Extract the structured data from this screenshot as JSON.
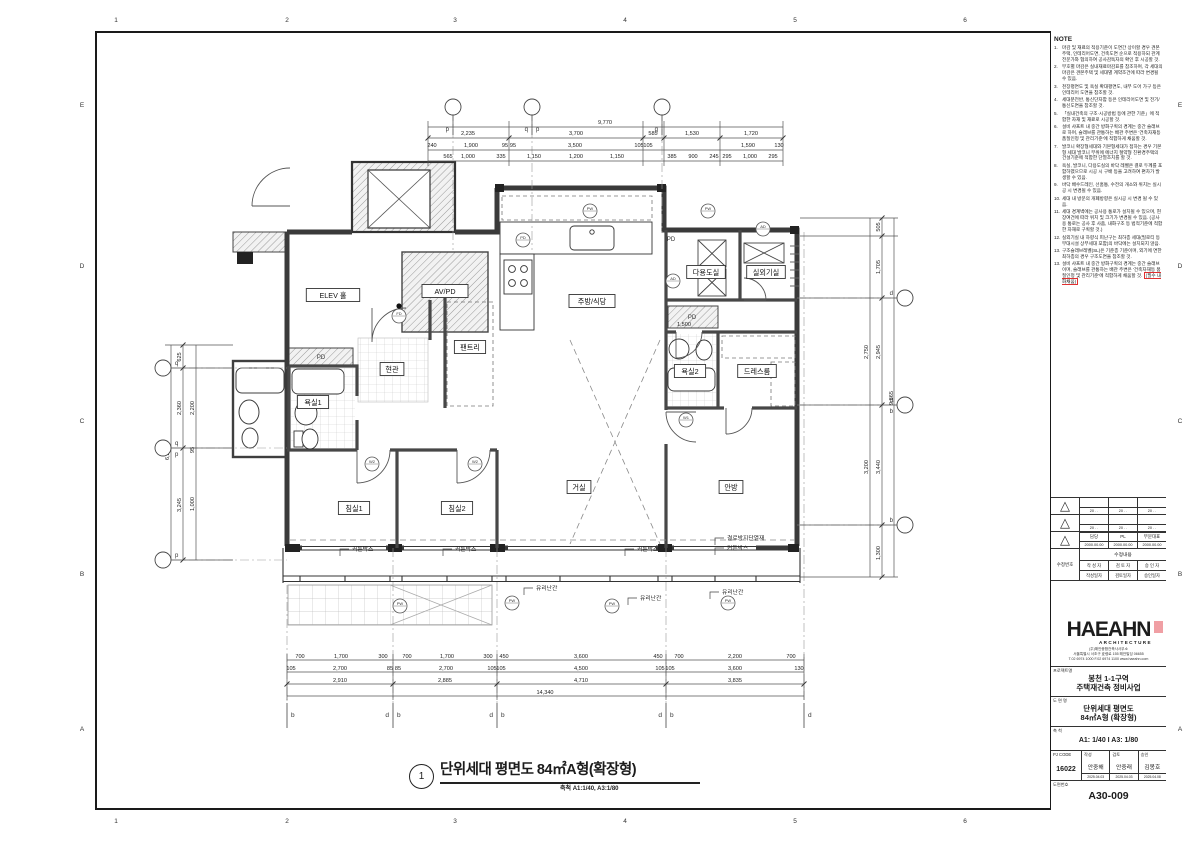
{
  "frame": {
    "cols": [
      "1",
      "2",
      "3",
      "4",
      "5",
      "6"
    ],
    "rows": [
      "E",
      "D",
      "C",
      "B",
      "A"
    ]
  },
  "notes": {
    "heading": "NOTE",
    "items": [
      {
        "no": "1.",
        "text": "마감 및 재료의 적용기준이 도면간 상이할 경우 견본주택, 인테리어도면, 건축도면 순으로 적용하되 관계전문가와 협의하여 공사감독자의 확인 후 시공할 것."
      },
      {
        "no": "2.",
        "text": "부호별 마감은 실내재료마감표를 참조하며, 각 세대의 마감은 견본주택 및 세대별 계약조건에 따라 변경될 수 있음."
      },
      {
        "no": "3.",
        "text": "천장평면도 및 욕실 확대평면도, 내부 도어 가구 등은 인테리어 도면을 참조할 것."
      },
      {
        "no": "4.",
        "text": "세대분전반, 통신단자함 등은 인테리어도면 및 전기/통신도면을 참조할 것."
      },
      {
        "no": "5.",
        "text": "「실내건축의 구조·시공방법 등에 관한 기준」에 적합한 자재 및 재료로 시공할 것."
      },
      {
        "no": "6.",
        "text": "설비 샤프트 내 중간 방화구획의 경계는 중간 슬래브로 하며, 슬래브를 관통하는 배관 주변은 '건축자재등 품질인정 및 관리기준'에 적합하게 채움할 것."
      },
      {
        "no": "7.",
        "text": "발코니 확장형세대와 기본형세대가 접하는 경우 기본형 세대 발코니 부위에 에너지 절약형 친환경주택의 건설기준에 적합한 단열조치를 할 것."
      },
      {
        "no": "8.",
        "text": "욕실, 발코니, 다용도실의 바닥 레벨은 결로 두께를 포함하였으므로 시공 시 구배 등을 고려하여 편차가 발생할 수 있음."
      },
      {
        "no": "9.",
        "text": "바닥 배수드레인, 선홈통, 수전의 개소와 위치는 실시공 시 변경될 수 있음."
      },
      {
        "no": "10.",
        "text": "세대 내 방문의 개폐방향은 실시공 시 변경 될 수 있음."
      },
      {
        "no": "11.",
        "text": "세대 경계벽에는 공사용 통로가 설치될 수 있으며, 현장여건에 따라 위치 및 크기가 변경될 수 있음. (공사용 통로는 공사 후 사춤, 내화구조 등 법적기준에 적합한 자재로 구획할 것.)"
      },
      {
        "no": "12.",
        "text": "실외기실 내 하향식 피난구는 최하층 세대(필로티 등 부대시설 상부세대 포함)의 바닥에는 설치되지 않음."
      },
      {
        "no": "13.",
        "text": "구조슬래브레벨(SL)은 기준층 기준이며, 외기에 면한 최하층의 경우 구조도면을 참조할 것."
      },
      {
        "no": "13.",
        "text": "설비 샤프트 내 중간 방화구획의 경계는 중간 슬래브이며, 슬래브를 관통하는 배관 주변은 '건축자재등 품질인정 및 관리기준'에 적합하게 채움할 것.",
        "hl": "(필수 내화채움)"
      }
    ]
  },
  "revision": {
    "rows": [
      {
        "cells": [
          "",
          "",
          ""
        ],
        "dates": [
          "20    .    .",
          "20    .    .",
          "20    .    ."
        ]
      },
      {
        "cells": [
          "",
          "",
          ""
        ],
        "dates": [
          "20    .    .",
          "20    .    .",
          "20    .    ."
        ]
      },
      {
        "cells": [
          "담당",
          "PL",
          "부문대표"
        ],
        "dates": [
          "2000.00.00",
          "2000.00.00",
          "2000.00.00"
        ]
      }
    ],
    "modify_label": "수정번호",
    "content_label": "수정내용",
    "writer_headers": [
      "작 성 자",
      "검 토 자",
      "승 인 자"
    ],
    "date_headers": [
      "작성일자",
      "검토일자",
      "승인일자"
    ]
  },
  "company": {
    "name": "HAEAHN",
    "sub": "ARCHITECTURE",
    "lines": [
      "(주)해안종합건축사사무소",
      "서울특별시 서초구 효령로 155 해안빌딩 06655",
      "T.02 6974 1000  F.02 6974 1100  www.haeahn.com"
    ]
  },
  "titleblock": {
    "project_label": "프로젝트명",
    "project_line1": "봉천 1-1구역",
    "project_line2": "주택재건축 정비사업",
    "drawing_label": "도 면 명",
    "drawing_line1": "단위세대 평면도",
    "drawing_line2": "84㎡A형 (확장형)",
    "scale_label": "축  척",
    "scale_value": "A1: 1/40  I  A3: 1/80",
    "pj_code_label": "PJ CODE",
    "pj_code": "16022",
    "staff": [
      {
        "role": "작성",
        "name": "안중해",
        "date": "2025.04.03"
      },
      {
        "role": "검토",
        "name": "안중래",
        "date": "2025.04.03"
      },
      {
        "role": "승인",
        "name": "김봉호",
        "date": "2025.04.08"
      }
    ],
    "drawing_no_label": "도면번호",
    "drawing_no": "A30-009"
  },
  "drawing_title": {
    "no": "1",
    "text": "단위세대 평면도 84㎡A형(확장형)",
    "scale": "축척 A1:1/40, A3:1/80"
  },
  "plan": {
    "rooms": [
      {
        "t": "ELEV 홀",
        "x": 333,
        "y": 295
      },
      {
        "t": "AV/PD",
        "x": 445,
        "y": 291
      },
      {
        "t": "현관",
        "x": 392,
        "y": 369
      },
      {
        "t": "욕실1",
        "x": 313,
        "y": 402
      },
      {
        "t": "팬트리",
        "x": 470,
        "y": 347
      },
      {
        "t": "주방/식당",
        "x": 592,
        "y": 301
      },
      {
        "t": "다용도실",
        "x": 706,
        "y": 272
      },
      {
        "t": "실외기실",
        "x": 766,
        "y": 272
      },
      {
        "t": "욕실2",
        "x": 690,
        "y": 371
      },
      {
        "t": "드레스룸",
        "x": 757,
        "y": 371
      },
      {
        "t": "침실1",
        "x": 354,
        "y": 508
      },
      {
        "t": "침실2",
        "x": 457,
        "y": 508
      },
      {
        "t": "거실",
        "x": 579,
        "y": 487
      },
      {
        "t": "안방",
        "x": 731,
        "y": 487
      }
    ],
    "small_labels": [
      {
        "t": "PD",
        "x": 321,
        "y": 359
      },
      {
        "t": "PD",
        "x": 671,
        "y": 241
      },
      {
        "t": "PD",
        "x": 692,
        "y": 319
      }
    ],
    "callouts": [
      {
        "t": "커튼박스",
        "x": 352,
        "y": 551
      },
      {
        "t": "커튼박스",
        "x": 455,
        "y": 551
      },
      {
        "t": "커튼박스",
        "x": 637,
        "y": 551
      },
      {
        "t": "결로방지단열재",
        "x": 727,
        "y": 540
      },
      {
        "t": "커튼박스",
        "x": 727,
        "y": 550
      },
      {
        "t": "유리난간",
        "x": 536,
        "y": 590
      },
      {
        "t": "유리난간",
        "x": 640,
        "y": 600
      },
      {
        "t": "유리난간",
        "x": 722,
        "y": 594
      }
    ],
    "tags": [
      {
        "t": "FD",
        "x": 399,
        "y": 316
      },
      {
        "t": "PD",
        "x": 523,
        "y": 240
      },
      {
        "t": "PW",
        "x": 590,
        "y": 211
      },
      {
        "t": "PW",
        "x": 708,
        "y": 211
      },
      {
        "t": "AD",
        "x": 763,
        "y": 229
      },
      {
        "t": "AD",
        "x": 673,
        "y": 281
      },
      {
        "t": "W2",
        "x": 372,
        "y": 464
      },
      {
        "t": "W2",
        "x": 475,
        "y": 464
      },
      {
        "t": "W1",
        "x": 686,
        "y": 420
      },
      {
        "t": "PW",
        "x": 400,
        "y": 606
      },
      {
        "t": "PW",
        "x": 512,
        "y": 603
      },
      {
        "t": "PW",
        "x": 612,
        "y": 606
      },
      {
        "t": "PW",
        "x": 728,
        "y": 603
      }
    ],
    "dims": {
      "top": [
        {
          "t": "9,770",
          "x": 605,
          "y": 124
        },
        {
          "t": "2,235",
          "x": 468,
          "y": 135
        },
        {
          "t": "3,700",
          "x": 576,
          "y": 135
        },
        {
          "t": "585",
          "x": 653,
          "y": 135
        },
        {
          "t": "1,530",
          "x": 692,
          "y": 135
        },
        {
          "t": "1,720",
          "x": 751,
          "y": 135
        },
        {
          "t": "240",
          "x": 432,
          "y": 147
        },
        {
          "t": "1,900",
          "x": 471,
          "y": 147
        },
        {
          "t": "95",
          "x": 505,
          "y": 147
        },
        {
          "t": "95",
          "x": 513,
          "y": 147
        },
        {
          "t": "3,500",
          "x": 575,
          "y": 147
        },
        {
          "t": "105",
          "x": 639,
          "y": 147
        },
        {
          "t": "105",
          "x": 648,
          "y": 147
        },
        {
          "t": "1,590",
          "x": 748,
          "y": 147
        },
        {
          "t": "130",
          "x": 779,
          "y": 147
        },
        {
          "t": "565",
          "x": 448,
          "y": 158
        },
        {
          "t": "1,000",
          "x": 468,
          "y": 158
        },
        {
          "t": "335",
          "x": 501,
          "y": 158
        },
        {
          "t": "1,150",
          "x": 534,
          "y": 158
        },
        {
          "t": "1,200",
          "x": 576,
          "y": 158
        },
        {
          "t": "1,150",
          "x": 617,
          "y": 158
        },
        {
          "t": "385",
          "x": 672,
          "y": 158
        },
        {
          "t": "900",
          "x": 693,
          "y": 158
        },
        {
          "t": "245",
          "x": 714,
          "y": 158
        },
        {
          "t": "295",
          "x": 727,
          "y": 158
        },
        {
          "t": "1,000",
          "x": 750,
          "y": 158
        },
        {
          "t": "295",
          "x": 773,
          "y": 158
        }
      ],
      "bottom": [
        {
          "t": "700",
          "x": 300,
          "y": 658
        },
        {
          "t": "1,700",
          "x": 341,
          "y": 658
        },
        {
          "t": "300",
          "x": 383,
          "y": 658
        },
        {
          "t": "700",
          "x": 407,
          "y": 658
        },
        {
          "t": "1,700",
          "x": 447,
          "y": 658
        },
        {
          "t": "300",
          "x": 488,
          "y": 658
        },
        {
          "t": "450",
          "x": 504,
          "y": 658
        },
        {
          "t": "3,600",
          "x": 581,
          "y": 658
        },
        {
          "t": "450",
          "x": 658,
          "y": 658
        },
        {
          "t": "700",
          "x": 679,
          "y": 658
        },
        {
          "t": "2,200",
          "x": 735,
          "y": 658
        },
        {
          "t": "700",
          "x": 791,
          "y": 658
        },
        {
          "t": "105",
          "x": 291,
          "y": 670
        },
        {
          "t": "2,700",
          "x": 340,
          "y": 670
        },
        {
          "t": "85",
          "x": 390,
          "y": 670
        },
        {
          "t": "85",
          "x": 398,
          "y": 670
        },
        {
          "t": "2,700",
          "x": 446,
          "y": 670
        },
        {
          "t": "105",
          "x": 492,
          "y": 670
        },
        {
          "t": "105",
          "x": 501,
          "y": 670
        },
        {
          "t": "4,500",
          "x": 581,
          "y": 670
        },
        {
          "t": "105",
          "x": 660,
          "y": 670
        },
        {
          "t": "105",
          "x": 670,
          "y": 670
        },
        {
          "t": "3,600",
          "x": 735,
          "y": 670
        },
        {
          "t": "130",
          "x": 799,
          "y": 670
        },
        {
          "t": "2,910",
          "x": 340,
          "y": 682
        },
        {
          "t": "2,885",
          "x": 445,
          "y": 682
        },
        {
          "t": "4,710",
          "x": 581,
          "y": 682
        },
        {
          "t": "3,835",
          "x": 735,
          "y": 682
        },
        {
          "t": "14,340",
          "x": 545,
          "y": 694
        }
      ],
      "left": [
        {
          "t": "6,230",
          "x": 169,
          "y": 453,
          "r": 1
        },
        {
          "t": "625",
          "x": 181,
          "y": 357,
          "r": 1
        },
        {
          "t": "2,360",
          "x": 181,
          "y": 408,
          "r": 1
        },
        {
          "t": "3,245",
          "x": 181,
          "y": 505,
          "r": 1
        },
        {
          "t": "2,200",
          "x": 194,
          "y": 408,
          "r": 1
        },
        {
          "t": "95",
          "x": 194,
          "y": 450,
          "r": 1
        },
        {
          "t": "1,000",
          "x": 194,
          "y": 504,
          "r": 1
        }
      ],
      "right": [
        {
          "t": "9,865",
          "x": 893,
          "y": 398,
          "r": 1
        },
        {
          "t": "505",
          "x": 880,
          "y": 227,
          "r": 1
        },
        {
          "t": "1,705",
          "x": 880,
          "y": 267,
          "r": 1
        },
        {
          "t": "2,945",
          "x": 880,
          "y": 352,
          "r": 1
        },
        {
          "t": "3,440",
          "x": 880,
          "y": 467,
          "r": 1
        },
        {
          "t": "1,300",
          "x": 880,
          "y": 553,
          "r": 1
        },
        {
          "t": "2,750",
          "x": 868,
          "y": 352,
          "r": 1
        },
        {
          "t": "3,200",
          "x": 868,
          "y": 467,
          "r": 1
        }
      ],
      "inner": [
        {
          "t": "1,500",
          "x": 684,
          "y": 326
        }
      ]
    },
    "grids": {
      "top": [
        {
          "l": "p",
          "x": 453
        },
        {
          "l": "q p",
          "x": 532
        },
        {
          "l": "q",
          "x": 662
        }
      ],
      "bottom": [
        {
          "l": "b",
          "x": 287
        },
        {
          "l": "d b",
          "x": 393
        },
        {
          "l": "d b",
          "x": 497
        },
        {
          "l": "d b",
          "x": 666
        },
        {
          "l": "d",
          "x": 804
        }
      ],
      "left": [
        {
          "l": "q",
          "y": 368
        },
        {
          "l": "q p",
          "y": 448
        },
        {
          "l": "p",
          "y": 560
        }
      ],
      "right": [
        {
          "l": "d",
          "y": 298
        },
        {
          "l": "d b",
          "y": 405
        },
        {
          "l": "b",
          "y": 525
        }
      ]
    }
  }
}
